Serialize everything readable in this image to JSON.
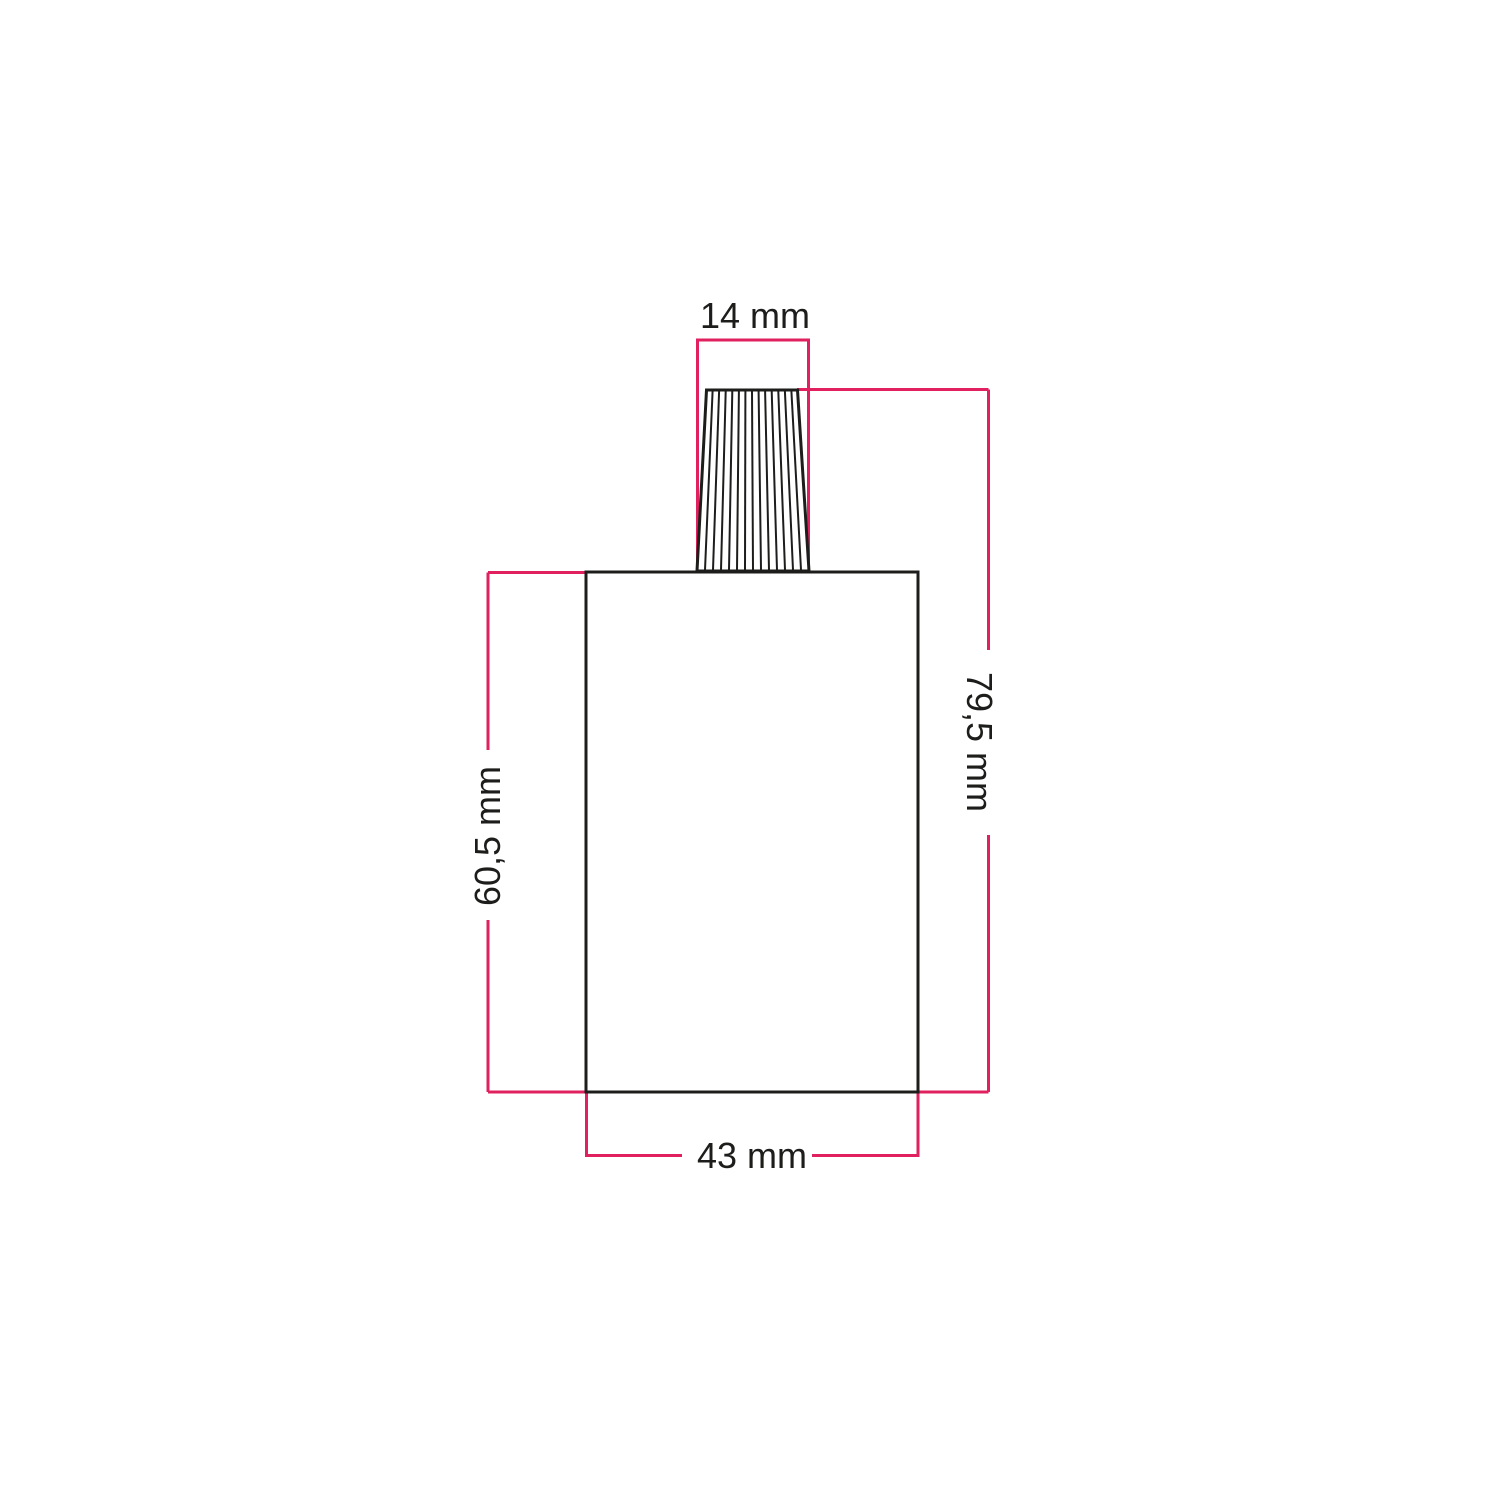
{
  "colors": {
    "background": "#ffffff",
    "dimension_line": "#e1205f",
    "drawing_line": "#1d1d1b",
    "label_text": "#1d1d1b"
  },
  "dimensions": {
    "cable_gland_width": {
      "label": "14 mm"
    },
    "total_height": {
      "label": "79,5 mm"
    },
    "body_height": {
      "label": "60,5 mm"
    },
    "body_width": {
      "label": "43 mm"
    }
  }
}
